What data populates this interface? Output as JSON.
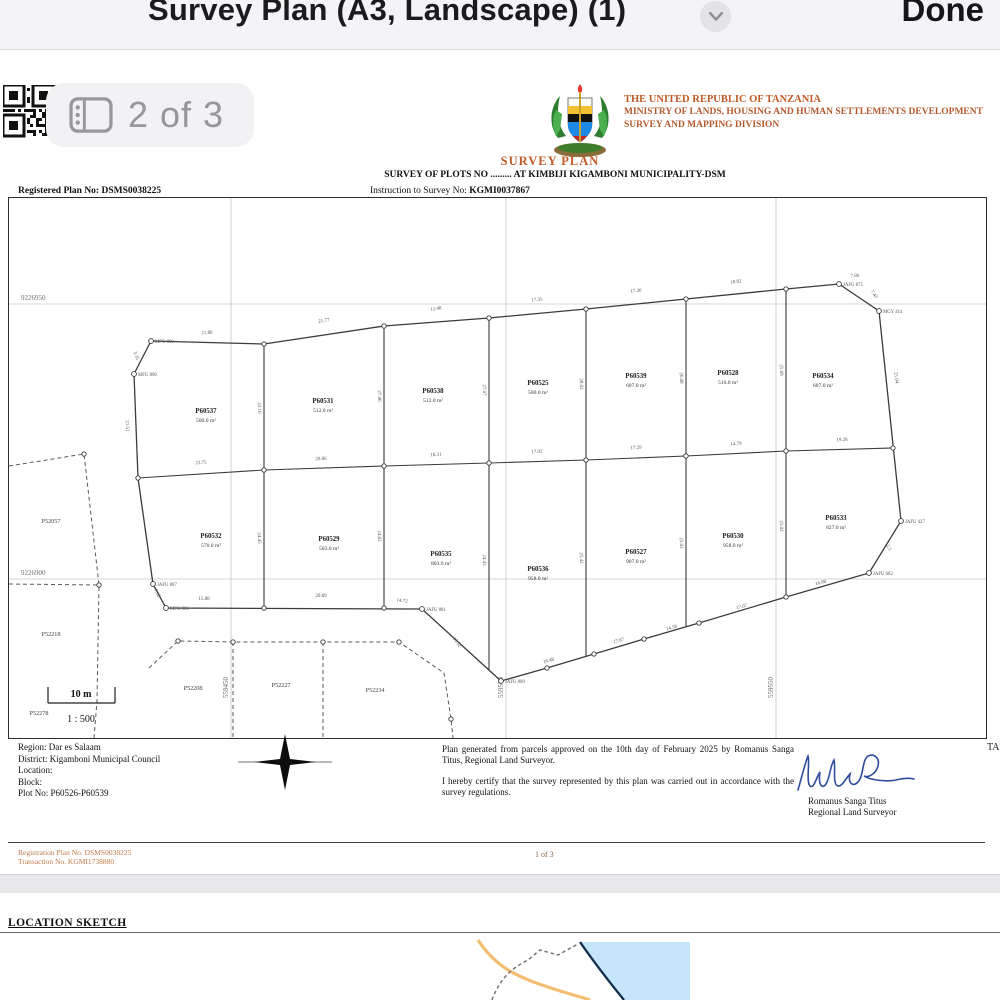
{
  "chrome": {
    "title": "Survey Plan (A3, Landscape) (1)",
    "done_label": "Done",
    "page_badge": "2 of 3"
  },
  "header": {
    "country": "THE UNITED REPUBLIC OF TANZANIA",
    "ministry": "MINISTRY OF LANDS, HOUSING AND HUMAN SETTLEMENTS DEVELOPMENT",
    "division": "SURVEY AND MAPPING DIVISION",
    "doc_title": "SURVEY PLAN",
    "subtitle": "SURVEY OF PLOTS NO ......... AT KIMBIJI KIGAMBONI MUNICIPALITY-DSM",
    "registered_plan": "Registered Plan No: DSMS0038225",
    "instruction_label": "Instruction to Survey No: ",
    "instruction_value": "KGMI0037867"
  },
  "map": {
    "grid": {
      "horizontal": [
        {
          "label": "9226950",
          "y": 106
        },
        {
          "label": "9226900",
          "y": 381
        }
      ],
      "vertical": [
        {
          "label": "559450",
          "x": 222
        },
        {
          "label": "559500",
          "x": 497
        },
        {
          "label": "559550",
          "x": 767
        }
      ]
    },
    "plots": [
      {
        "id": "P60537",
        "area": "500.0 m²",
        "x": 197,
        "y": 215
      },
      {
        "id": "P60531",
        "area": "512.0 m²",
        "x": 314,
        "y": 205
      },
      {
        "id": "P60538",
        "area": "512.0 m²",
        "x": 424,
        "y": 195
      },
      {
        "id": "P60525",
        "area": "500.0 m²",
        "x": 529,
        "y": 187
      },
      {
        "id": "P60539",
        "area": "607.0 m²",
        "x": 627,
        "y": 180
      },
      {
        "id": "P60528",
        "area": "510.0 m²",
        "x": 719,
        "y": 177
      },
      {
        "id": "P60534",
        "area": "607.0 m²",
        "x": 814,
        "y": 180
      },
      {
        "id": "P60532",
        "area": "570.0 m²",
        "x": 202,
        "y": 340
      },
      {
        "id": "P60529",
        "area": "503.0 m²",
        "x": 320,
        "y": 343
      },
      {
        "id": "P60535",
        "area": "803.0 m²",
        "x": 432,
        "y": 358
      },
      {
        "id": "P60536",
        "area": "958.0 m²",
        "x": 529,
        "y": 373
      },
      {
        "id": "P60527",
        "area": "907.0 m²",
        "x": 627,
        "y": 356
      },
      {
        "id": "P60530",
        "area": "958.0 m²",
        "x": 724,
        "y": 340
      },
      {
        "id": "P60533",
        "area": "827.0 m²",
        "x": 827,
        "y": 322
      }
    ],
    "neighbor_plots": [
      {
        "id": "P52057",
        "x": 42,
        "y": 325
      },
      {
        "id": "P52218",
        "x": 42,
        "y": 438
      },
      {
        "id": "P52278",
        "x": 30,
        "y": 517
      },
      {
        "id": "P52208",
        "x": 184,
        "y": 492
      },
      {
        "id": "P52227",
        "x": 272,
        "y": 489
      },
      {
        "id": "P52234",
        "x": 366,
        "y": 494
      }
    ],
    "beacons": [
      {
        "label": "MFG 880",
        "x": 142,
        "y": 143
      },
      {
        "label": "MFG 896",
        "x": 125,
        "y": 176
      },
      {
        "label": "JAFU 875",
        "x": 830,
        "y": 86
      },
      {
        "label": "MGY 414",
        "x": 870,
        "y": 113
      },
      {
        "label": "JAFU 427",
        "x": 892,
        "y": 323
      },
      {
        "label": "JAFU 682",
        "x": 860,
        "y": 375
      },
      {
        "label": "JAFU 880",
        "x": 492,
        "y": 483
      },
      {
        "label": "JAFU 881",
        "x": 413,
        "y": 411
      },
      {
        "label": "JAFU 887",
        "x": 144,
        "y": 386
      },
      {
        "label": "MFG 886",
        "x": 157,
        "y": 410
      }
    ],
    "measurements": [
      {
        "t": "21.80",
        "x": 198,
        "y": 136,
        "r": -3
      },
      {
        "t": "21.77",
        "x": 315,
        "y": 124,
        "r": -9
      },
      {
        "t": "12.48",
        "x": 427,
        "y": 112,
        "r": -6
      },
      {
        "t": "17.35",
        "x": 528,
        "y": 103,
        "r": -5
      },
      {
        "t": "17.30",
        "x": 627,
        "y": 94,
        "r": -5
      },
      {
        "t": "18.82",
        "x": 727,
        "y": 85,
        "r": -6
      },
      {
        "t": "7.86",
        "x": 846,
        "y": 79,
        "r": -3
      },
      {
        "t": "7.42",
        "x": 864,
        "y": 97,
        "r": 55
      },
      {
        "t": "3.35",
        "x": 126,
        "y": 158,
        "r": 72
      },
      {
        "t": "21.51",
        "x": 117,
        "y": 228,
        "r": 87
      },
      {
        "t": "23.75",
        "x": 192,
        "y": 266,
        "r": -2
      },
      {
        "t": "20.86",
        "x": 312,
        "y": 262,
        "r": -2
      },
      {
        "t": "18.31",
        "x": 427,
        "y": 258,
        "r": -2
      },
      {
        "t": "17.02",
        "x": 528,
        "y": 255,
        "r": -2
      },
      {
        "t": "17.29",
        "x": 627,
        "y": 251,
        "r": -2
      },
      {
        "t": "14.79",
        "x": 727,
        "y": 247,
        "r": -2
      },
      {
        "t": "19.28",
        "x": 833,
        "y": 243,
        "r": -2
      },
      {
        "t": "21.04",
        "x": 886,
        "y": 180,
        "r": 84
      },
      {
        "t": "15.88",
        "x": 195,
        "y": 402,
        "r": 0
      },
      {
        "t": "20.89",
        "x": 312,
        "y": 399,
        "r": 0
      },
      {
        "t": "14.72",
        "x": 393,
        "y": 404,
        "r": 6
      },
      {
        "t": "11.52",
        "x": 447,
        "y": 445,
        "r": 56
      },
      {
        "t": "16.48",
        "x": 540,
        "y": 464,
        "r": -17
      },
      {
        "t": "17.67",
        "x": 610,
        "y": 444,
        "r": -17
      },
      {
        "t": "14.58",
        "x": 663,
        "y": 431,
        "r": -17
      },
      {
        "t": "17.07",
        "x": 733,
        "y": 410,
        "r": -16
      },
      {
        "t": "16.98",
        "x": 812,
        "y": 386,
        "r": -15
      },
      {
        "t": "7.32",
        "x": 147,
        "y": 396,
        "r": 60
      },
      {
        "t": "12.5",
        "x": 878,
        "y": 349,
        "r": 62
      },
      {
        "t": "22.16",
        "x": 249,
        "y": 210,
        "r": 88
      },
      {
        "t": "27.06",
        "x": 369,
        "y": 198,
        "r": 88
      },
      {
        "t": "27.07",
        "x": 474,
        "y": 192,
        "r": 88
      },
      {
        "t": "28.02",
        "x": 571,
        "y": 186,
        "r": 88
      },
      {
        "t": "26.08",
        "x": 671,
        "y": 180,
        "r": 88
      },
      {
        "t": "25.09",
        "x": 771,
        "y": 172,
        "r": 88
      },
      {
        "t": "24.45",
        "x": 249,
        "y": 340,
        "r": 88
      },
      {
        "t": "24.02",
        "x": 369,
        "y": 338,
        "r": 88
      },
      {
        "t": "24.43",
        "x": 474,
        "y": 362,
        "r": 88
      },
      {
        "t": "25.42",
        "x": 571,
        "y": 360,
        "r": 88
      },
      {
        "t": "25.02",
        "x": 671,
        "y": 345,
        "r": 88
      },
      {
        "t": "25.92",
        "x": 771,
        "y": 328,
        "r": 88
      }
    ],
    "scale": {
      "bar_label": "10 m",
      "ratio_label": "1 : 500"
    },
    "edge_note": "TA"
  },
  "info": {
    "rows": [
      "Region: Dar es Salaam",
      "District: Kigamboni Municipal Council",
      "Location:",
      "Block:",
      "Plot No: P60526-P60539"
    ]
  },
  "certification": {
    "para1": "Plan generated from parcels approved on the 10th day of February 2025 by Romanus Sanga Titus, Regional Land Surveyor.",
    "para2": " I hereby certify that the survey represented by this plan was carried out in accordance with the survey regulations.",
    "signer_name": "Romanus Sanga Titus",
    "signer_title": "Regional Land Surveyor"
  },
  "footer": {
    "registration": "Registration Plan No. DSMS0038225",
    "transaction": "Transaction No. KGMI1738880",
    "page": "1 of 3"
  },
  "sketch": {
    "heading": "LOCATION SKETCH"
  },
  "colors": {
    "accent_orange": "#c25a27",
    "footer_orange": "#c07a49",
    "water": "#c5e5fa",
    "road": "#f5bd72",
    "signature_blue": "#2f4d9e"
  }
}
